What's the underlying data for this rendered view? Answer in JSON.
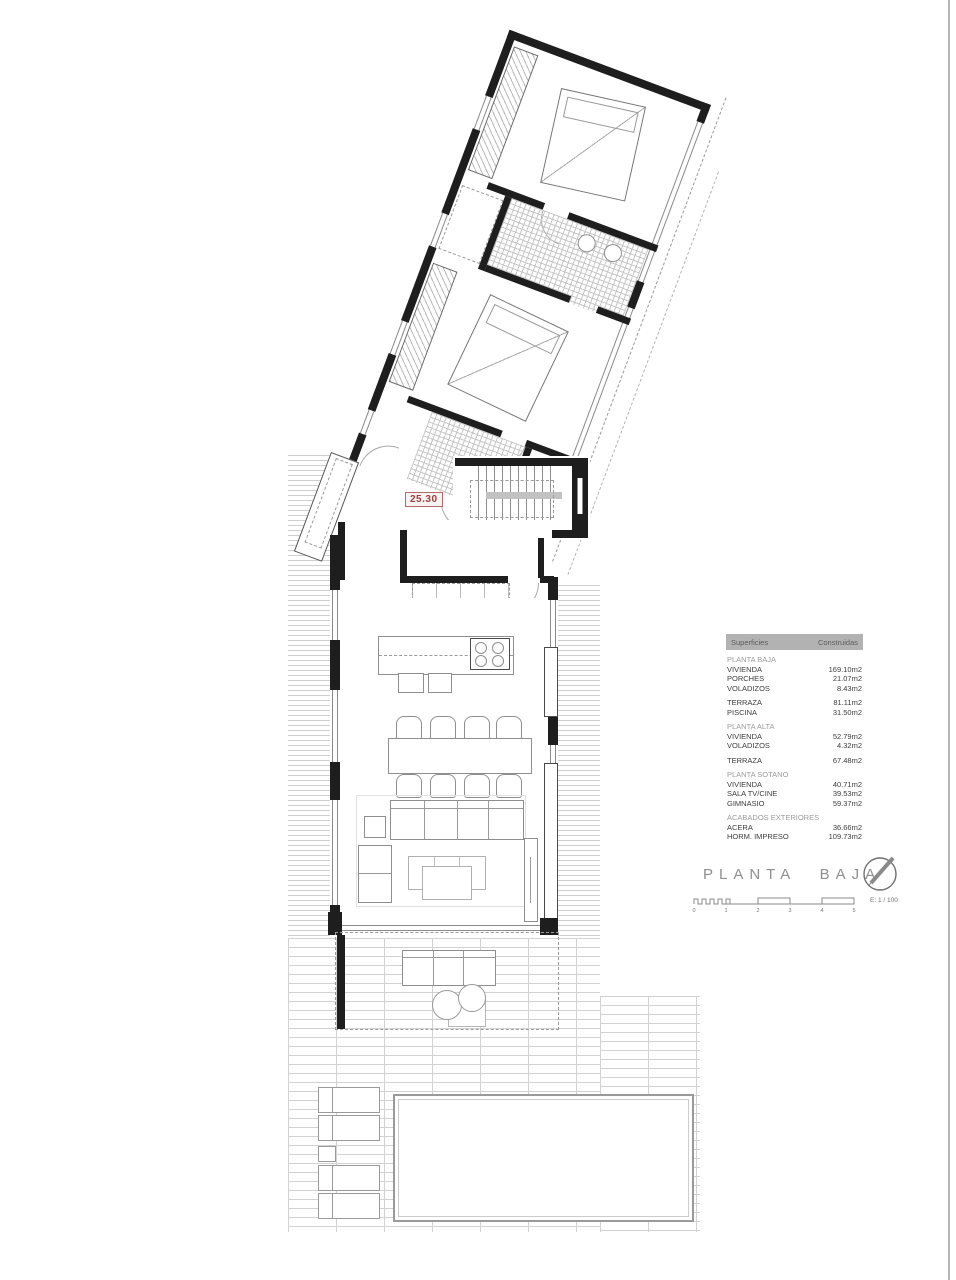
{
  "colors": {
    "accent_red": "#9c4040",
    "wall_black": "#1e1e1e",
    "hatch_gray": "#cfcfcf",
    "legend_header_bg": "#b2b2b2",
    "legend_section_gray": "#9b9b9b",
    "title_gray": "#8f8f8f"
  },
  "plan": {
    "dim_label": "25.30"
  },
  "legend": {
    "header": {
      "col1": "Superficies",
      "col2": "Construidas"
    },
    "rows": [
      {
        "type": "section",
        "label": "PLANTA BAJA"
      },
      {
        "label": "VIVIENDA",
        "value": "169.10m2"
      },
      {
        "label": "PORCHES",
        "value": "21.07m2"
      },
      {
        "label": "VOLADIZOS",
        "value": "8.43m2"
      },
      {
        "label": "TERRAZA",
        "value": "81.11m2"
      },
      {
        "label": "PISCINA",
        "value": "31.50m2"
      },
      {
        "type": "section",
        "label": "PLANTA ALTA"
      },
      {
        "label": "VIVIENDA",
        "value": "52.79m2"
      },
      {
        "label": "VOLADIZOS",
        "value": "4.32m2"
      },
      {
        "label": "TERRAZA",
        "value": "67.48m2"
      },
      {
        "type": "section",
        "label": "PLANTA SOTANO"
      },
      {
        "label": "VIVIENDA",
        "value": "40.71m2"
      },
      {
        "label": "SALA TV/CINE",
        "value": "39.53m2"
      },
      {
        "label": "GIMNASIO",
        "value": "59.37m2"
      },
      {
        "type": "section",
        "label": "ACABADOS EXTERIORES"
      },
      {
        "label": "ACERA",
        "value": "36.66m2"
      },
      {
        "label": "HORM. IMPRESO",
        "value": "109.73m2"
      }
    ]
  },
  "titleblock": {
    "title": "PLANTA BAJA",
    "scale_label": "E: 1 / 100",
    "ticks": [
      "0",
      "1",
      "2",
      "3",
      "4",
      "5"
    ]
  }
}
